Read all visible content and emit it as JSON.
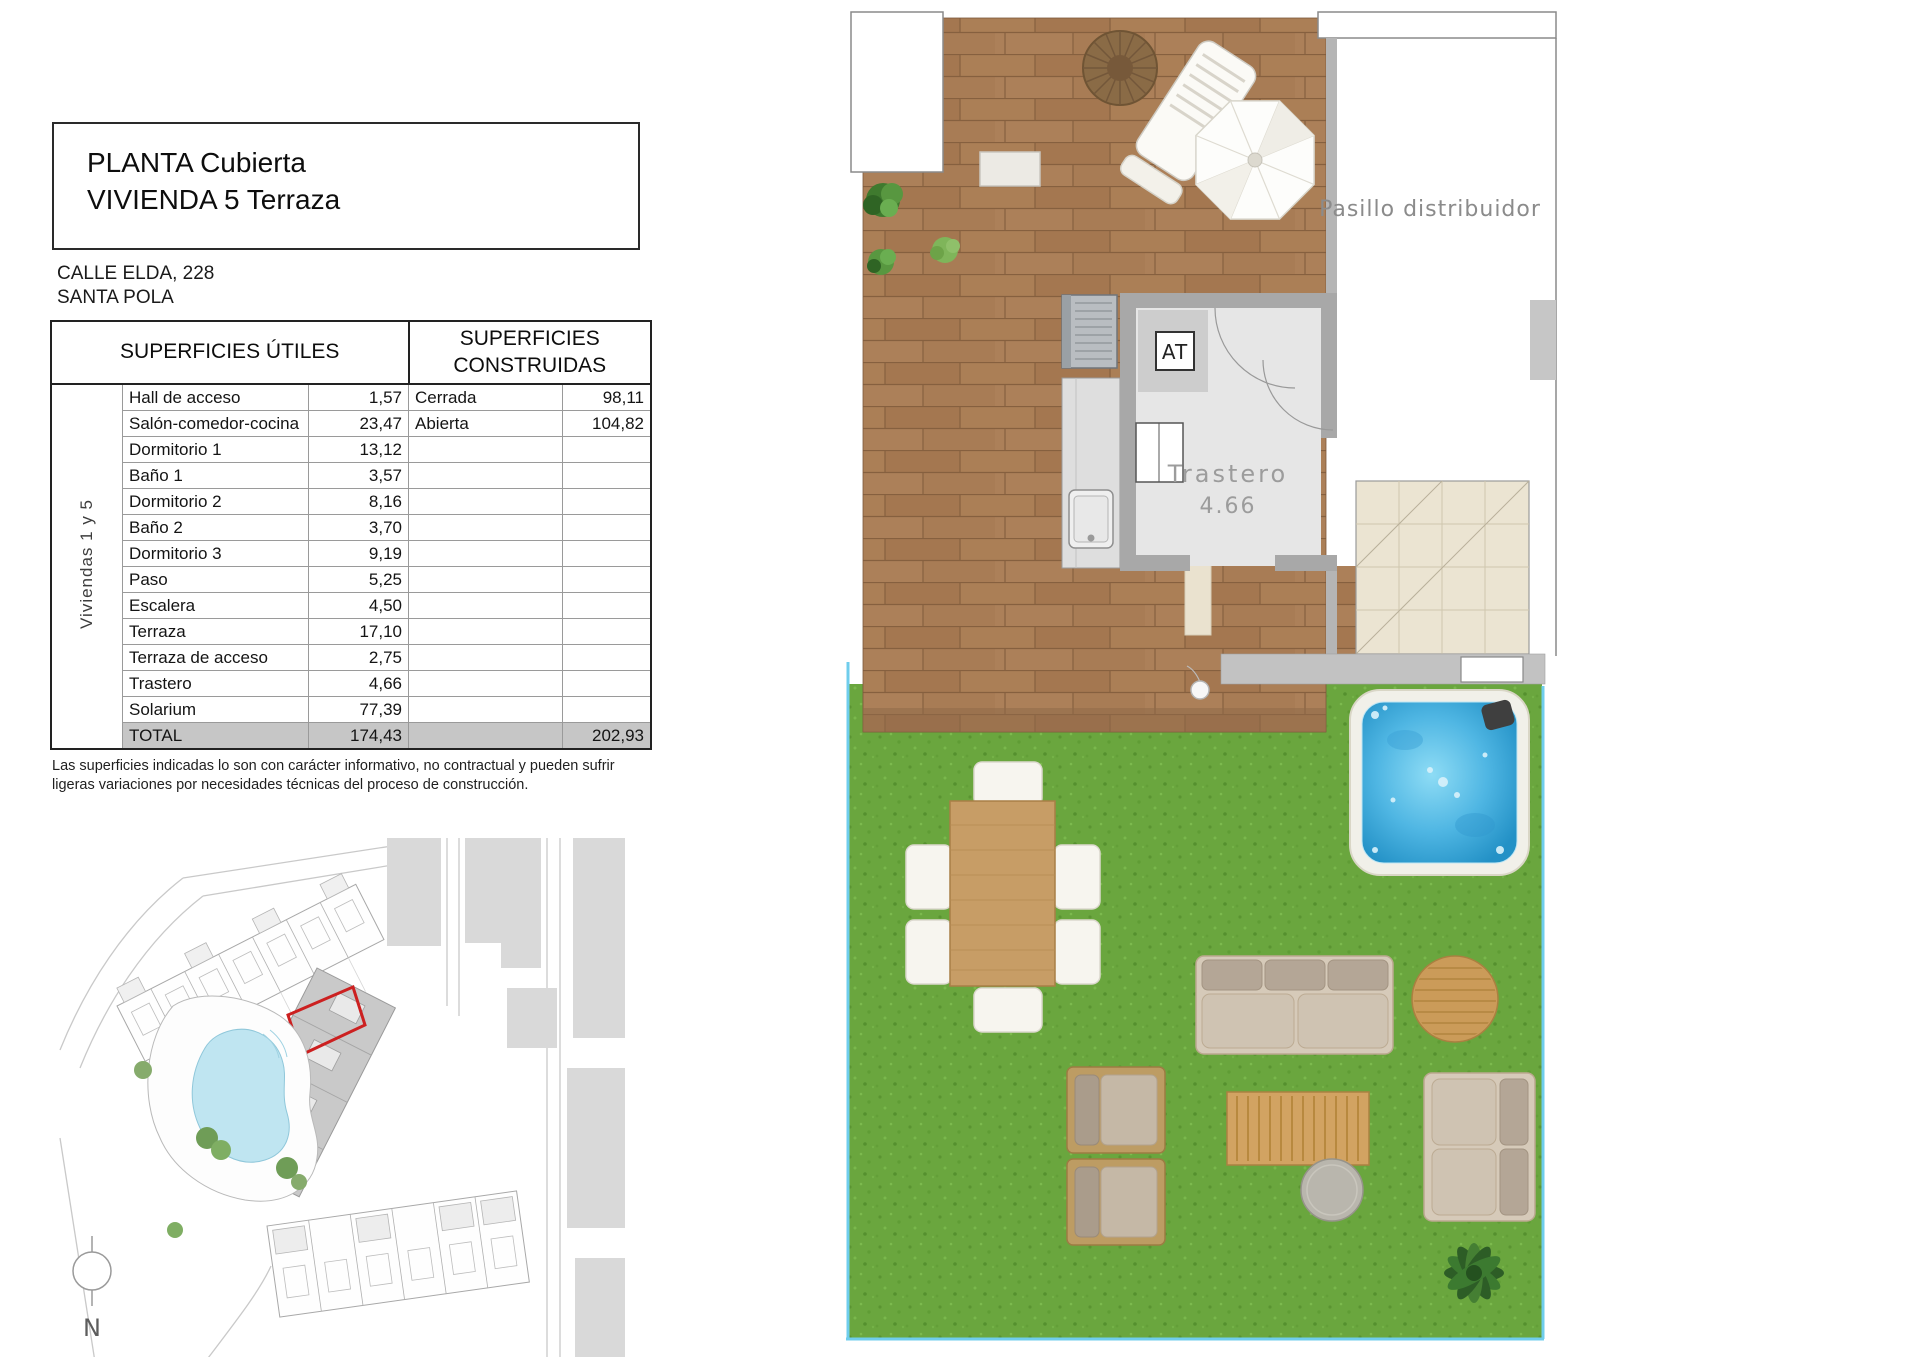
{
  "sheet": {
    "title_line1": "PLANTA Cubierta",
    "title_line2": "VIVIENDA 5 Terraza",
    "address_line1": "CALLE ELDA, 228",
    "address_line2": "SANTA POLA",
    "disclaimer": "Las superficies indicadas lo son con carácter informativo, no contractual y pueden sufrir ligeras variaciones por necesidades técnicas del proceso de construcción."
  },
  "areas_table": {
    "header_utiles": "SUPERFICIES ÚTILES",
    "header_construidas": "SUPERFICIES CONSTRUIDAS",
    "side_label": "Viviendas 1 y 5",
    "rows": [
      {
        "name": "Hall de acceso",
        "value": "1,57",
        "cons_name": "Cerrada",
        "cons_value": "98,11"
      },
      {
        "name": "Salón-comedor-cocina",
        "value": "23,47",
        "cons_name": "Abierta",
        "cons_value": "104,82"
      },
      {
        "name": "Dormitorio 1",
        "value": "13,12",
        "cons_name": "",
        "cons_value": ""
      },
      {
        "name": "Baño 1",
        "value": "3,57",
        "cons_name": "",
        "cons_value": ""
      },
      {
        "name": "Dormitorio 2",
        "value": "8,16",
        "cons_name": "",
        "cons_value": ""
      },
      {
        "name": "Baño 2",
        "value": "3,70",
        "cons_name": "",
        "cons_value": ""
      },
      {
        "name": "Dormitorio 3",
        "value": "9,19",
        "cons_name": "",
        "cons_value": ""
      },
      {
        "name": "Paso",
        "value": "5,25",
        "cons_name": "",
        "cons_value": ""
      },
      {
        "name": "Escalera",
        "value": "4,50",
        "cons_name": "",
        "cons_value": ""
      },
      {
        "name": "Terraza",
        "value": "17,10",
        "cons_name": "",
        "cons_value": ""
      },
      {
        "name": "Terraza de acceso",
        "value": "2,75",
        "cons_name": "",
        "cons_value": ""
      },
      {
        "name": "Trastero",
        "value": "4,66",
        "cons_name": "",
        "cons_value": ""
      },
      {
        "name": "Solarium",
        "value": "77,39",
        "cons_name": "",
        "cons_value": ""
      },
      {
        "name": "TOTAL",
        "value": "174,43",
        "cons_name": "",
        "cons_value": "202,93",
        "is_total": true
      }
    ]
  },
  "floor_plan": {
    "corridor_label": "Pasillo distribuidor",
    "room_label": "Trastero",
    "room_area": "4.66",
    "at_label": "AT"
  },
  "site_plan": {
    "north_label": "N"
  },
  "colors": {
    "accent_red": "#cc2020",
    "deck_wood": "#a87c55",
    "grass_green": "#6aa63e",
    "water_blue": "#4fb6e3",
    "wall_gray": "#a8a8a8",
    "total_row_bg": "#c6c6c6"
  }
}
